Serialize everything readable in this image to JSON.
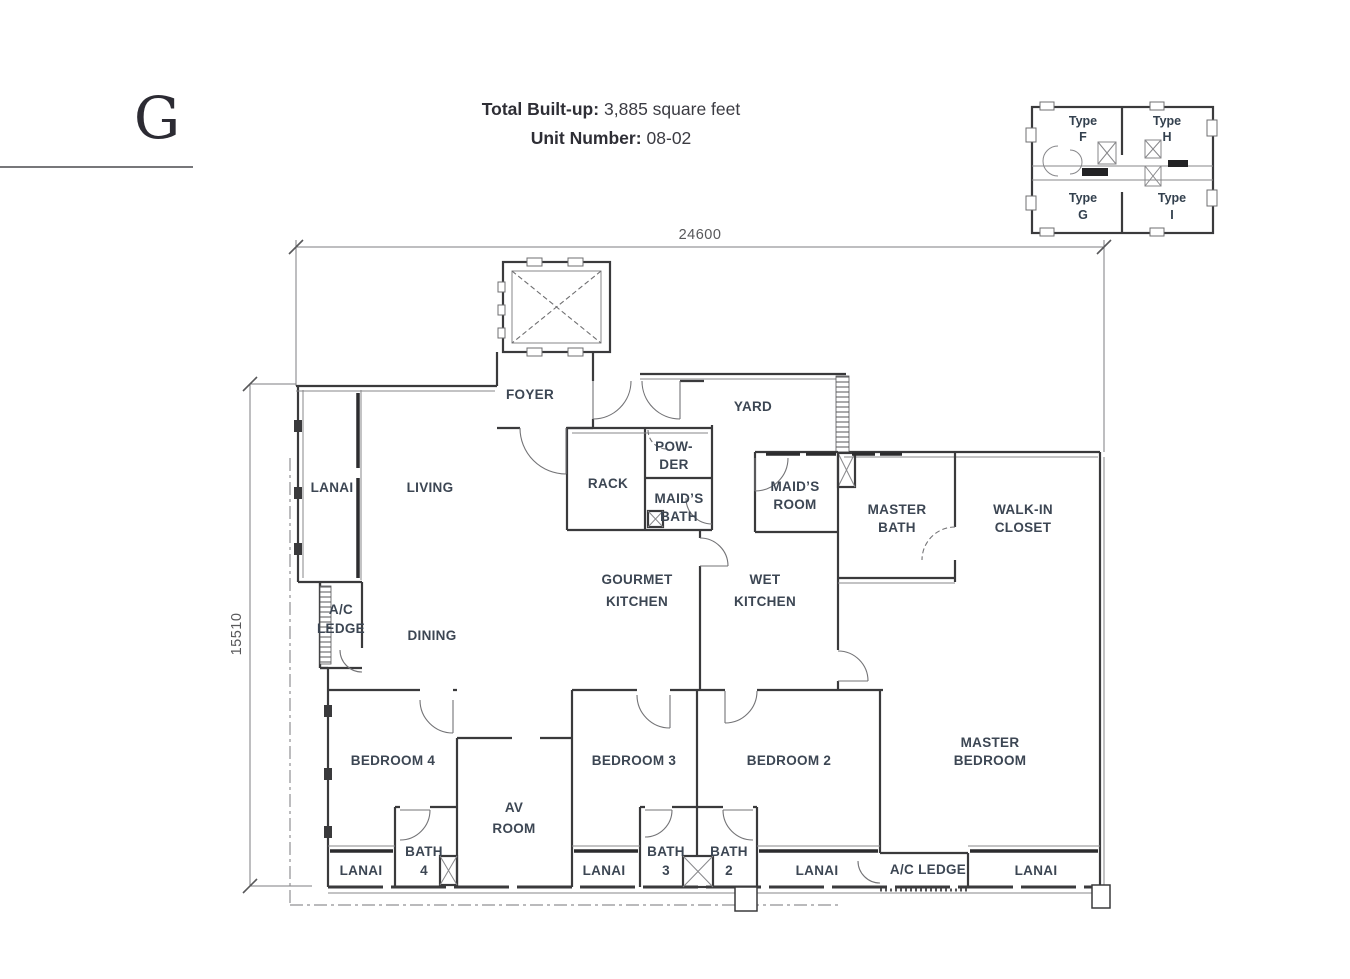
{
  "header": {
    "letter": "G",
    "line1_label": "Total Built-up:",
    "line1_value": "3,885 square feet",
    "line2_label": "Unit Number:",
    "line2_value": "08-02"
  },
  "dimensions": {
    "width": "24600",
    "height": "15510"
  },
  "key_plan": {
    "f1": "Type",
    "f2": "F",
    "h1": "Type",
    "h2": "H",
    "g1": "Type",
    "g2": "G",
    "i1": "Type",
    "i2": "I"
  },
  "rooms": {
    "foyer": "FOYER",
    "yard": "YARD",
    "powder1": "POW-",
    "powder2": "DER",
    "rack": "RACK",
    "maids_bath1": "MAID’S",
    "maids_bath2": "BATH",
    "maids_room1": "MAID’S",
    "maids_room2": "ROOM",
    "master_bath1": "MASTER",
    "master_bath2": "BATH",
    "wic1": "WALK-IN",
    "wic2": "CLOSET",
    "lanai_left": "LANAI",
    "living": "LIVING",
    "ac_ledge_left1": "A/C",
    "ac_ledge_left2": "LEDGE",
    "dining": "DINING",
    "gourmet1": "GOURMET",
    "gourmet2": "KITCHEN",
    "wet1": "WET",
    "wet2": "KITCHEN",
    "bedroom4": "BEDROOM 4",
    "av1": "AV",
    "av2": "ROOM",
    "bedroom3": "BEDROOM 3",
    "bedroom2": "BEDROOM 2",
    "master1": "MASTER",
    "master2": "BEDROOM",
    "lanai_bed4": "LANAI",
    "bath4_1": "BATH",
    "bath4_2": "4",
    "lanai_bed3": "LANAI",
    "bath3_1": "BATH",
    "bath3_2": "3",
    "bath2_1": "BATH",
    "bath2_2": "2",
    "lanai_bed2": "LANAI",
    "ac_ledge_bottom": "A/C LEDGE",
    "lanai_master": "LANAI"
  },
  "colors": {
    "label": "#3c4653",
    "wall": "#3a3a3c",
    "dimension": "#58585a"
  }
}
